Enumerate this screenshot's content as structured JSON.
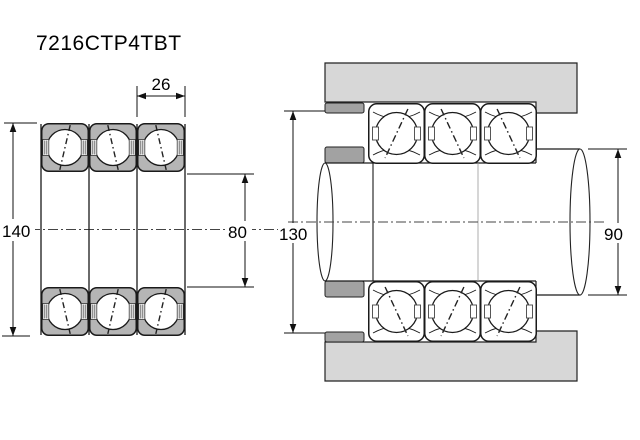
{
  "title": "7216CTP4TBT",
  "views": {
    "cross_section": {
      "label": "bearing set cross-section view",
      "dimensions": {
        "outside_diameter": "140",
        "bore_diameter": "80",
        "single_width": "26"
      }
    },
    "mounting": {
      "label": "shaft and housing mounting arrangement view",
      "dimensions": {
        "housing_abutment_diameter": "130",
        "shaft_abutment_diameter": "90"
      }
    }
  },
  "colors": {
    "background": "#ffffff",
    "line": "#1a1a1a",
    "housing_fill": "#d7d7d7",
    "spacer_fill": "#a2a2a2",
    "ring_fill": "#b5b5b5",
    "bearing_fill": "#ffffff"
  }
}
